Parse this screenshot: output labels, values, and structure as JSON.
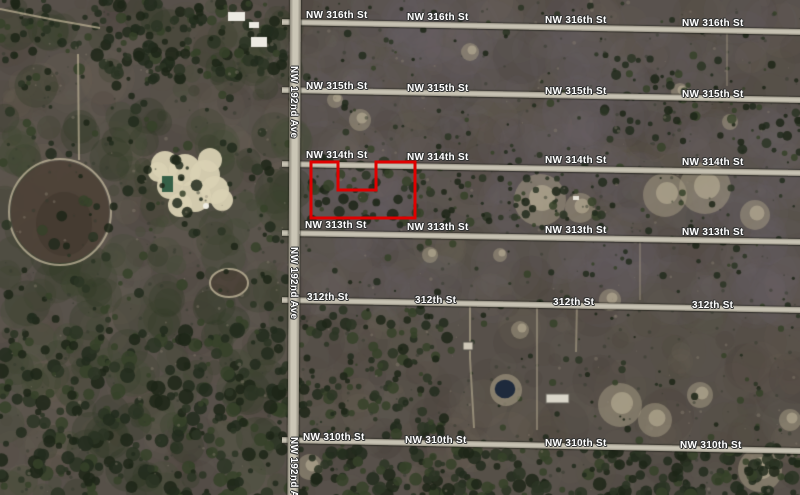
{
  "map": {
    "kind": "satellite-imagery",
    "road_fill": "#c6c1b2",
    "label_color": "#ffffff",
    "label_halo": "#303232"
  },
  "streets": [
    {
      "name": "NW 316th St",
      "y_left": 19,
      "y_right": 29,
      "label_xs": [
        306,
        407,
        545,
        682
      ],
      "label_dy": -9
    },
    {
      "name": "NW 315th St",
      "y_left": 87,
      "y_right": 97,
      "label_xs": [
        306,
        407,
        545,
        682
      ],
      "label_dy": -6
    },
    {
      "name": "NW 314th St",
      "y_left": 161,
      "y_right": 170,
      "label_xs": [
        306,
        407,
        545,
        682
      ],
      "label_dy": -11
    },
    {
      "name": "NW 313th St",
      "y_left": 230,
      "y_right": 239,
      "label_xs": [
        305,
        407,
        545,
        682
      ],
      "label_dy": -10
    },
    {
      "name": "312th St",
      "y_left": 297,
      "y_right": 307,
      "label_xs": [
        307,
        415,
        553,
        692
      ],
      "label_dy": -5
    },
    {
      "name": "NW 310th St",
      "y_left": 437,
      "y_right": 448,
      "label_xs": [
        303,
        405,
        545,
        680
      ],
      "label_dy": -5
    }
  ],
  "avenue": {
    "name": "NW 192nd Ave",
    "x_left": 290,
    "tilt_deg": 0.3,
    "label_ys": [
      66,
      247,
      437
    ]
  },
  "parcel": {
    "stroke": "#e00000",
    "stroke_width": 3,
    "points": [
      [
        311,
        162
      ],
      [
        338,
        162
      ],
      [
        338,
        190
      ],
      [
        376,
        190
      ],
      [
        376,
        162
      ],
      [
        415,
        162
      ],
      [
        415,
        218
      ],
      [
        311,
        218
      ]
    ]
  }
}
